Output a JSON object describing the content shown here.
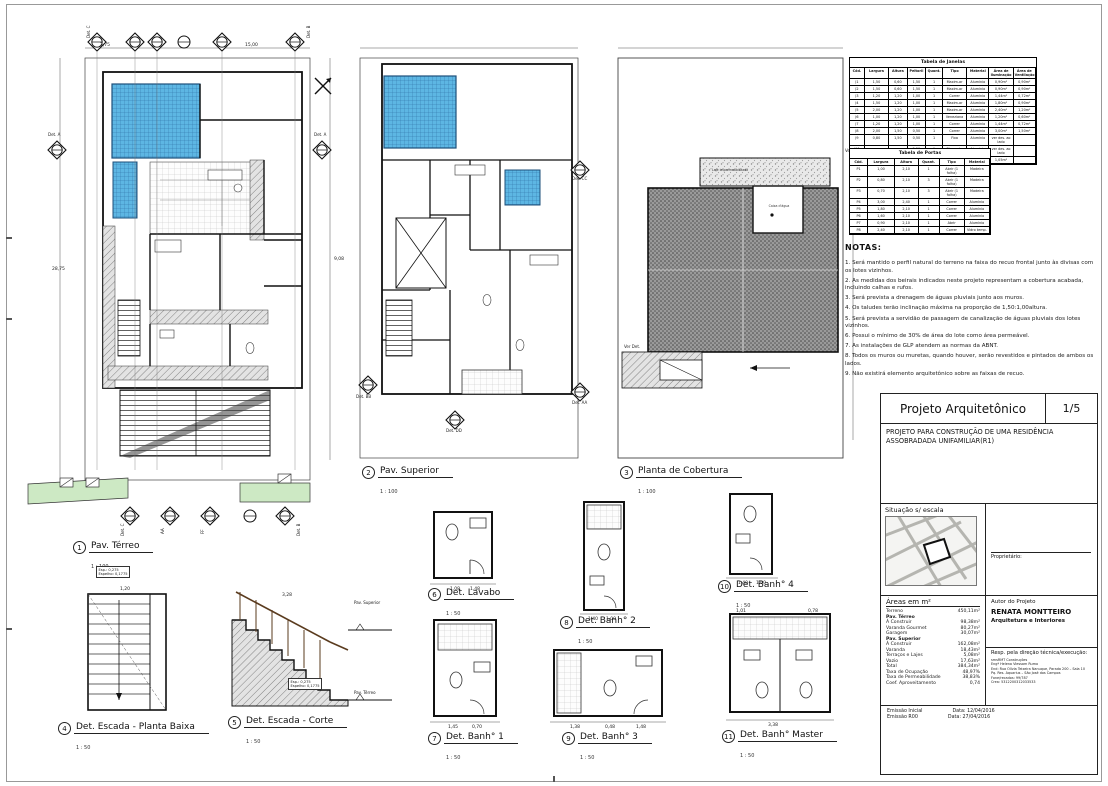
{
  "sheet_title": "Projeto Arquitetônico",
  "plans": [
    {
      "num": "1",
      "title": "Pav. Térreo",
      "scale": "1 : 100"
    },
    {
      "num": "2",
      "title": "Pav. Superior",
      "scale": "1 : 100"
    },
    {
      "num": "3",
      "title": "Planta de Cobertura",
      "scale": "1 : 100"
    },
    {
      "num": "4",
      "title": "Det. Escada - Planta Baixa",
      "scale": "1 : 50"
    },
    {
      "num": "5",
      "title": "Det. Escada - Corte",
      "scale": "1 : 50"
    },
    {
      "num": "6",
      "title": "Det. Lavabo",
      "scale": "1 : 50"
    },
    {
      "num": "7",
      "title": "Det. Banh° 1",
      "scale": "1 : 50"
    },
    {
      "num": "8",
      "title": "Det. Banh° 2",
      "scale": "1 : 50"
    },
    {
      "num": "9",
      "title": "Det. Banh° 3",
      "scale": "1 : 50"
    },
    {
      "num": "10",
      "title": "Det. Banh° 4",
      "scale": "1 : 50"
    },
    {
      "num": "11",
      "title": "Det. Banh° Master",
      "scale": "1 : 50"
    }
  ],
  "tables": {
    "janelas": {
      "title": "Tabela de Janelas",
      "rows": [
        [
          "Cód.",
          "Largura",
          "Altura",
          "Peitoril",
          "Quant.",
          "Tipo",
          "Material",
          "Área de Iluminação",
          "Área de Ventilação"
        ],
        [
          "J1",
          "1,50",
          "0,60",
          "1,50",
          "1",
          "Maxim-ar",
          "Alumínio",
          "0,90m²",
          "0,90m²"
        ],
        [
          "J2",
          "1,50",
          "0,60",
          "1,50",
          "1",
          "Maxim-ar",
          "Alumínio",
          "0,90m²",
          "0,90m²"
        ],
        [
          "J3",
          "1,20",
          "1,20",
          "1,00",
          "1",
          "Correr",
          "Alumínio",
          "1,44m²",
          "0,72m²"
        ],
        [
          "J4",
          "1,50",
          "1,20",
          "1,00",
          "1",
          "Maxim-ar",
          "Alumínio",
          "1,80m²",
          "0,90m²"
        ],
        [
          "J5",
          "2,00",
          "1,20",
          "1,00",
          "1",
          "Maxim-ar",
          "Alumínio",
          "2,40m²",
          "1,20m²"
        ],
        [
          "J6",
          "1,00",
          "1,20",
          "1,00",
          "1",
          "Veneziana",
          "Alumínio",
          "1,20m²",
          "0,60m²"
        ],
        [
          "J7",
          "1,20",
          "1,20",
          "1,00",
          "1",
          "Correr",
          "Alumínio",
          "1,44m²",
          "0,72m²"
        ],
        [
          "J8",
          "2,00",
          "1,50",
          "0,50",
          "1",
          "Correr",
          "Alumínio",
          "3,00m²",
          "1,50m²"
        ],
        [
          "J9",
          "0,80",
          "1,50",
          "0,50",
          "1",
          "Fixa",
          "Alumínio",
          "ver des. ao lado",
          ""
        ],
        [
          "J10",
          "",
          "",
          "2,50",
          "1",
          "Elemento vazado",
          "Alumínio",
          "ver des. ao lado",
          ""
        ],
        [
          "J11",
          "1,50",
          "0,70",
          "2,00",
          "1",
          "Fixa",
          "Alumínio",
          "1,05m²",
          ""
        ]
      ]
    },
    "portas": {
      "title": "Tabela de Portas",
      "rows": [
        [
          "Cód.",
          "Largura",
          "Altura",
          "Quant.",
          "Tipo",
          "Material"
        ],
        [
          "P1",
          "1,00",
          "2,10",
          "1",
          "Abrir (1 folha)",
          "Madeira"
        ],
        [
          "P2",
          "0,80",
          "2,10",
          "3",
          "Abrir (1 folha)",
          "Madeira"
        ],
        [
          "P3",
          "0,70",
          "2,10",
          "3",
          "Abrir (1 folha)",
          "Madeira"
        ],
        [
          "P4",
          "3,00",
          "2,40",
          "1",
          "Correr",
          "Alumínio"
        ],
        [
          "P5",
          "1,80",
          "2,10",
          "1",
          "Correr",
          "Alumínio"
        ],
        [
          "P6",
          "1,60",
          "2,10",
          "1",
          "Correr",
          "Alumínio"
        ],
        [
          "P7",
          "0,90",
          "2,10",
          "1",
          "Abrir",
          "Alumínio"
        ],
        [
          "P8",
          "2,40",
          "2,10",
          "1",
          "Correr",
          "Vidro temp."
        ]
      ]
    }
  },
  "notas": {
    "title": "NOTAS:",
    "items": [
      "1. Será mantido o perfil natural do terreno na faixa do recuo frontal junto  às divisas com os lotes vizinhos.",
      "2. As medidas dos beirais indicados neste projeto representam a cobertura acabada, incluindo calhas e rufos.",
      "3. Será prevista a drenagem de águas pluviais junto aos muros.",
      "4. Os taludes terão inclinação máxima na proporção de 1,50:1,00altura.",
      "5. Será prevista a servidão de passagem de canalização de águas pluviais dos lotes vizinhos.",
      "6. Possui o mínimo de 30% de área do lote como área permeável.",
      "7. As instalações de GLP atendem as normas da ABNT.",
      "8. Todos os muros ou muretas, quando houver, serão revestidos e pintados de ambos os lados.",
      "9. Não existirá elemento arquitetônico sobre as faixas de recuo."
    ]
  },
  "title_block": {
    "title": "Projeto Arquitetônico",
    "page": "1/5",
    "description": "PROJETO PARA CONSTRUÇÃO DE UMA RESIDÊNCIA ASSOBRADADA  UNIFAMILIAR(R1)",
    "situacao_label": "Situação s/ escala",
    "proprietario_label": "Proprietário:",
    "areas": {
      "title": "Áreas em m²",
      "rows": [
        [
          "Terreno",
          "450,11m²"
        ],
        [
          "",
          ""
        ],
        [
          "Pav. Térreo",
          ""
        ],
        [
          "Á Construir",
          "98,38m²"
        ],
        [
          "Varanda Gourmet",
          "80,27m²"
        ],
        [
          "Garagem",
          "30,07m²"
        ],
        [
          "",
          ""
        ],
        [
          "Pav. Superior",
          ""
        ],
        [
          "Á Construir",
          "162,08m²"
        ],
        [
          "Varanda",
          "18,43m²"
        ],
        [
          "Terraços e Lajes",
          "5,08m²"
        ],
        [
          "Vazio",
          "17,63m²"
        ],
        [
          "",
          ""
        ],
        [
          "Total",
          "384,34m²"
        ],
        [
          "",
          ""
        ],
        [
          "Taxa de Ocupação",
          "48,97%"
        ],
        [
          "Taxa de Permeabilidade",
          "38,83%"
        ],
        [
          "Coef. Aproveitamento",
          "0,74"
        ]
      ]
    },
    "autor": {
      "label": "Autor do Projeto",
      "name": "RENATA MONTTEIRO",
      "sub": "Arquitetura e Interiores"
    },
    "resp": {
      "label": "Resp. pela direção técnica/execução:",
      "lines": [
        "smsRMT Construções",
        "Engª Helena Viessam Rumo",
        "End: Rua Olívia Teixeira Nanuque, Parada 200 – Sala 10",
        "Pq. Res. Aquarius – São José dos Campos",
        "Fone/recados: 99/787",
        "Crea: 5312200312033533"
      ]
    },
    "emissao": {
      "rows": [
        [
          "Emissão Inicial",
          "Data: 12/04/2016"
        ],
        [
          "Emissão R00",
          "Data: 27/04/2016"
        ]
      ]
    }
  },
  "markers": {
    "det_a": "Det. A",
    "det_b": "Det. B",
    "det_c": "Det. C",
    "aa": "AA",
    "bb": "BB",
    "ff": "FF",
    "det_cc": "Det. CC",
    "det_bb": "Det. BB",
    "det_aa": "Det. AA",
    "det_dd": "Det. DD",
    "ver_det": "Ver Det."
  },
  "annotations": {
    "esp": "Esp.: 0,275",
    "espelho": "Espelho: 0,1775",
    "pav_superior": "Pav. Superior",
    "pav_terreo": "Pav. Térreo",
    "caixa": "Caixa d'água",
    "laje": "Laje impermeabilizada"
  },
  "dims": {
    "plan1": [
      "3,75",
      "15,00",
      "28,75",
      "9,08"
    ],
    "lavabo": [
      "1,08",
      "1,48",
      "0,70"
    ],
    "banh1": [
      "1,45",
      "0,70",
      "0,25"
    ],
    "banh2": [
      "1,40",
      "1,00"
    ],
    "banh3": [
      "1,38",
      "0,48",
      "1,48"
    ],
    "banh4": [
      "1,40",
      "1,00"
    ],
    "master": [
      "3,38",
      "1,01",
      "0,78"
    ],
    "escada": [
      "1,20",
      "3,28"
    ]
  },
  "colors": {
    "pool": "#5db6e3",
    "pool_line": "#2d6fa3",
    "grass": "#cde9c4",
    "roof": "#9a9a9a",
    "ink": "#1a1a1a"
  }
}
